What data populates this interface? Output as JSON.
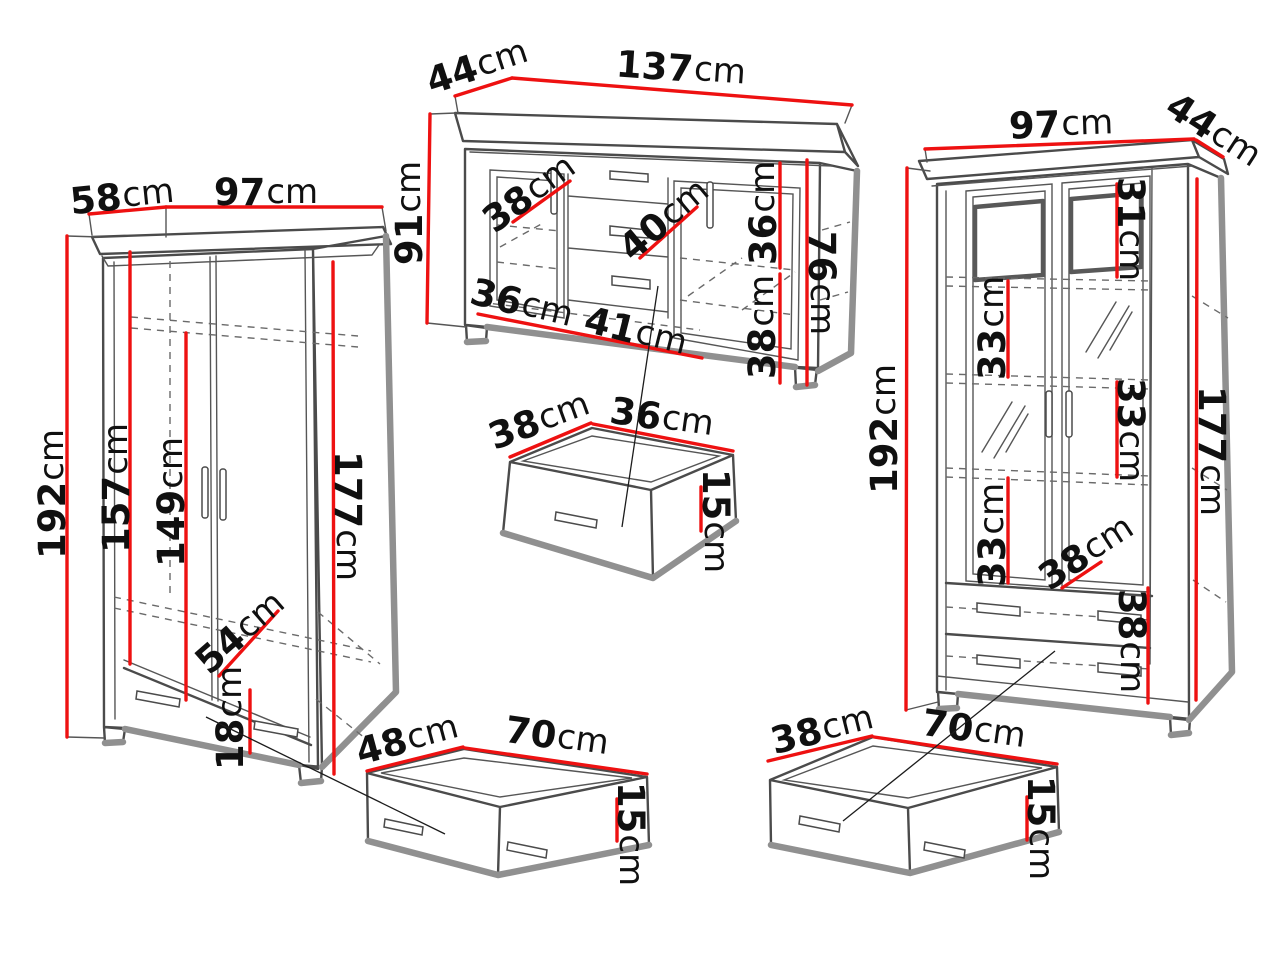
{
  "unit": "cm",
  "colors": {
    "dimension_line": "#ee1111",
    "outline": "#4b4b4b",
    "shadow": "#909090",
    "text": "#101010",
    "background": "#ffffff"
  },
  "pieces": {
    "wardrobe": {
      "name": "wardrobe",
      "dims": {
        "depth": "58",
        "width": "97",
        "height": "192",
        "interior_left": "157",
        "interior_center": "149",
        "interior_right": "177",
        "shelf_depth": "54",
        "drawer_height": "18"
      }
    },
    "sideboard": {
      "name": "sideboard",
      "dims": {
        "depth": "44",
        "width": "137",
        "height": "91",
        "shelf_left": "38",
        "shelf_center": "40",
        "right_upper": "36",
        "interior_height": "76",
        "right_lower": "38",
        "bottom_left": "36",
        "bottom_center": "41"
      }
    },
    "small_drawer": {
      "name": "small-drawer",
      "dims": {
        "depth": "38",
        "width": "36",
        "height": "15"
      }
    },
    "display_cabinet": {
      "name": "display-cabinet",
      "dims": {
        "width": "97",
        "depth": "44",
        "height": "192",
        "top_right": "31",
        "left_upper": "33",
        "right_middle": "33",
        "left_lower": "33",
        "shelf_depth": "38",
        "drawer_section": "38",
        "interior_right": "177"
      }
    },
    "center_drawer": {
      "name": "center-drawer",
      "dims": {
        "depth": "48",
        "width": "70",
        "height": "15"
      }
    },
    "right_drawer": {
      "name": "right-drawer",
      "dims": {
        "depth": "38",
        "width": "70",
        "height": "15"
      }
    }
  }
}
